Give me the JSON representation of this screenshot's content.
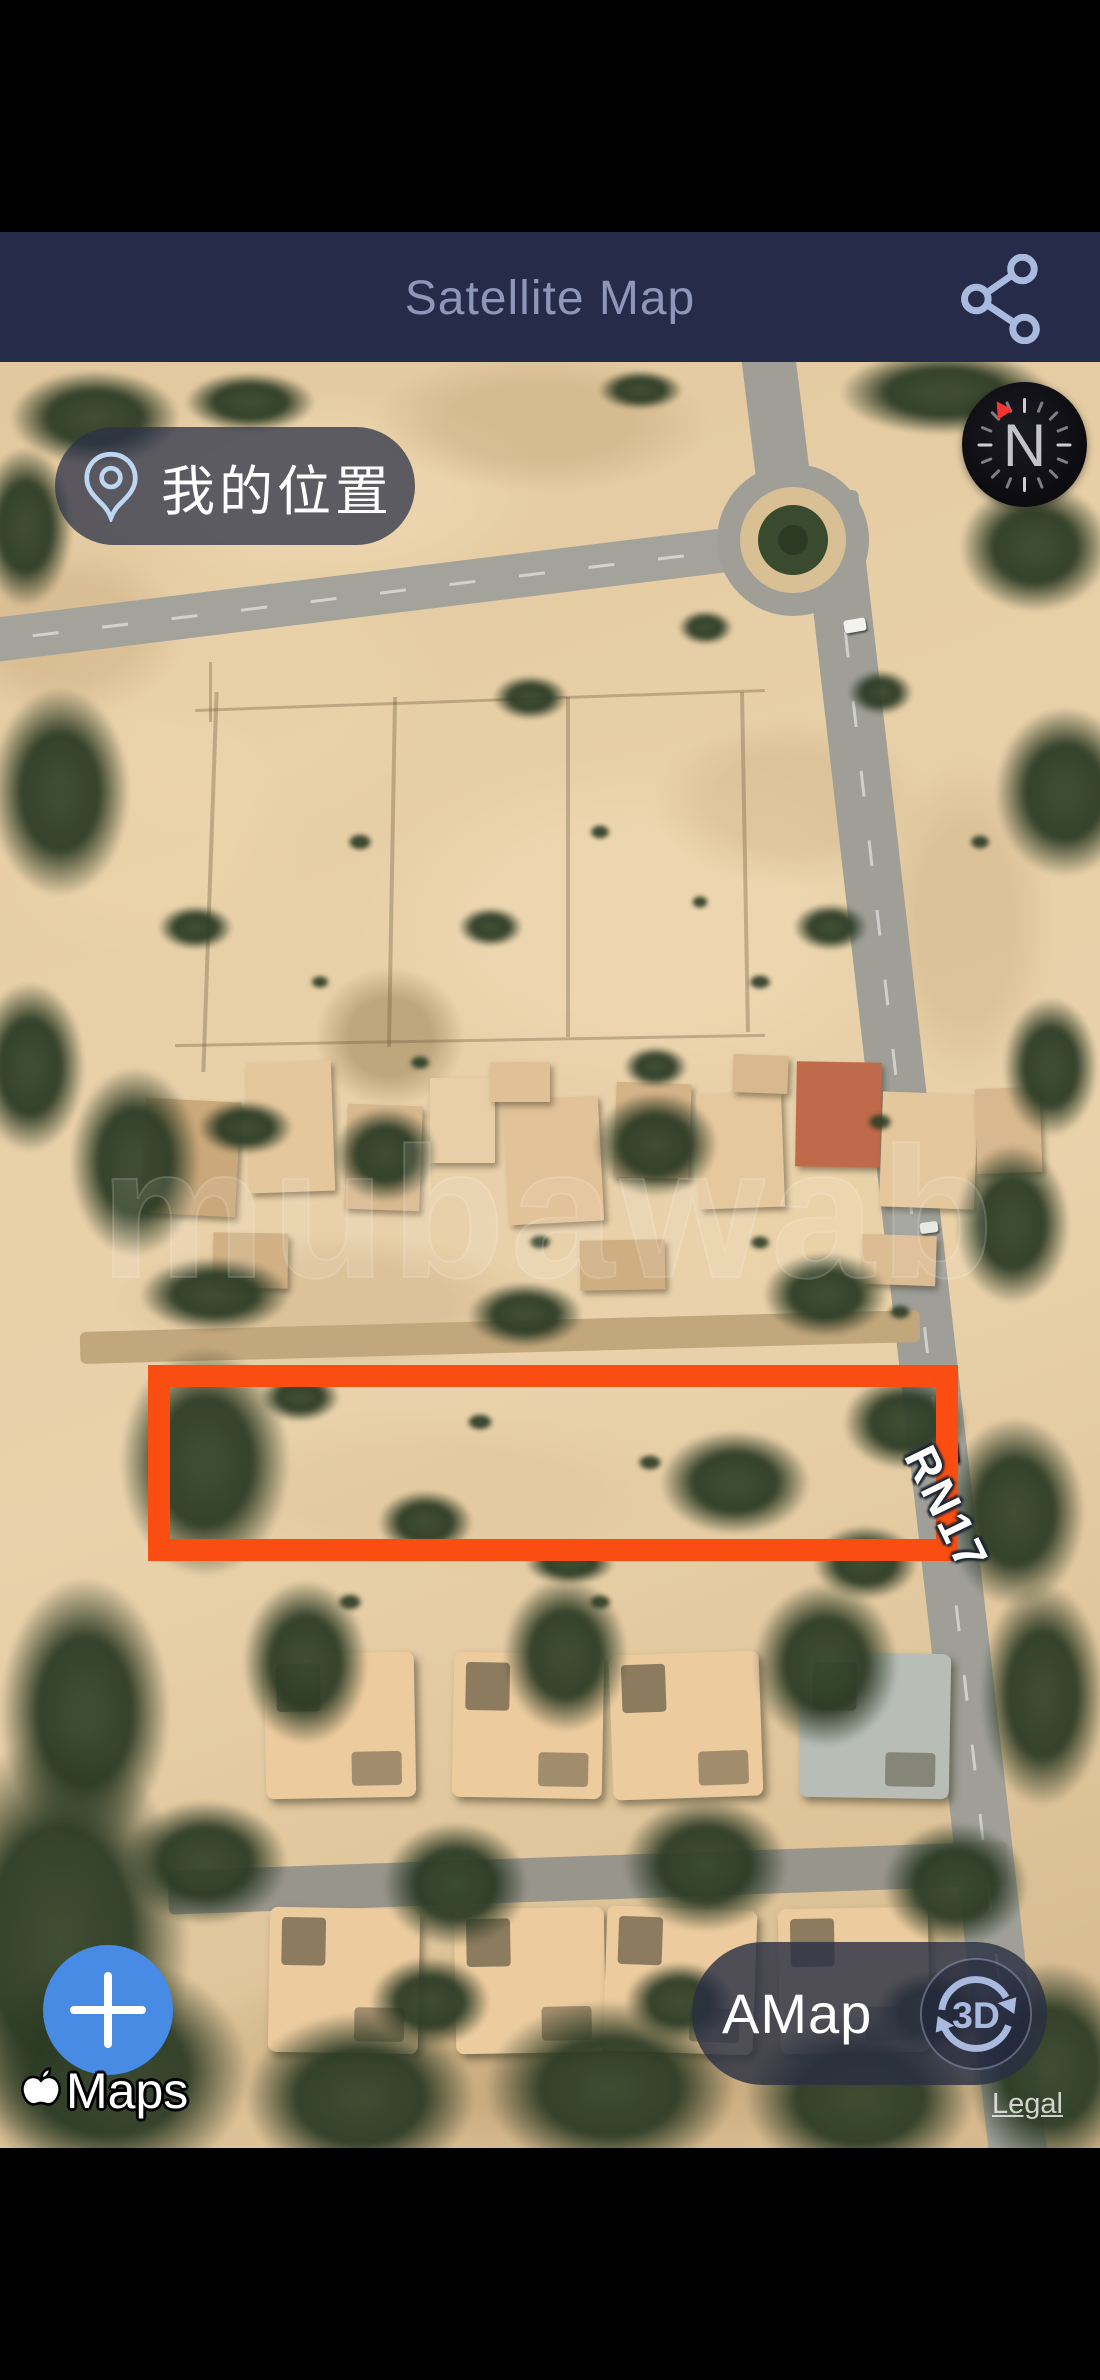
{
  "header": {
    "title": "Satellite Map"
  },
  "map": {
    "my_location_label": "我的位置",
    "compass_letter": "N",
    "road_label": "RN17",
    "watermark": "mubawab",
    "amap_label": "AMap",
    "threed_label": "3D",
    "legal_label": "Legal",
    "maps_attribution_label": "Maps"
  },
  "colors": {
    "header_bg": "#262b49",
    "header_fg": "#8e96ba",
    "icon_periwinkle": "#a9bade",
    "plot_outline": "#f94d12",
    "zoom_button_blue": "#478be4",
    "control_pill_bg": "rgba(40,46,68,0.8)",
    "compass_needle_red": "#f43530",
    "location_pin_blue": "#bdd6f2"
  }
}
